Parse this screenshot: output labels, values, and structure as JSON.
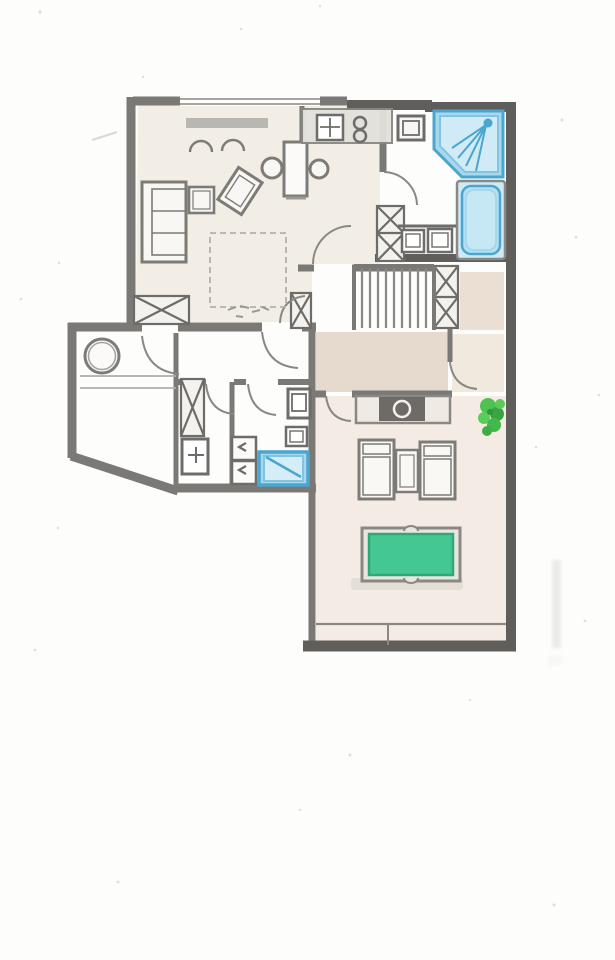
{
  "canvas": {
    "width": 615,
    "height": 960,
    "background": "#fdfdfc"
  },
  "palette": {
    "wall": "#7b7975",
    "wall_dark": "#605e5a",
    "line": "#8a8884",
    "line_soft": "#b3b1ad",
    "furniture": "#7d7b77",
    "furniture_fill": "#f9f7f4",
    "floor_living": "#efe8de",
    "floor_corridor": "#e2d2c4",
    "floor_landing": "#e6d6c8",
    "floor_lobby": "#ece0d4",
    "floor_bedroom": "#f3eae1",
    "fixture_blue": "#a9d8ee",
    "fixture_blue_stroke": "#4aa6cf",
    "fixture_blue_light": "#d4edf7",
    "tub_fill": "#cfe9f5",
    "table_green": "#45c792",
    "table_green_dark": "#2fa878",
    "plant_green": "#3fbe45",
    "plant_green_dark": "#2b9e38",
    "shadow": "#d8d3cb",
    "counter_fill": "#e3e1dc",
    "appliance_dark": "#6e6b66"
  }
}
